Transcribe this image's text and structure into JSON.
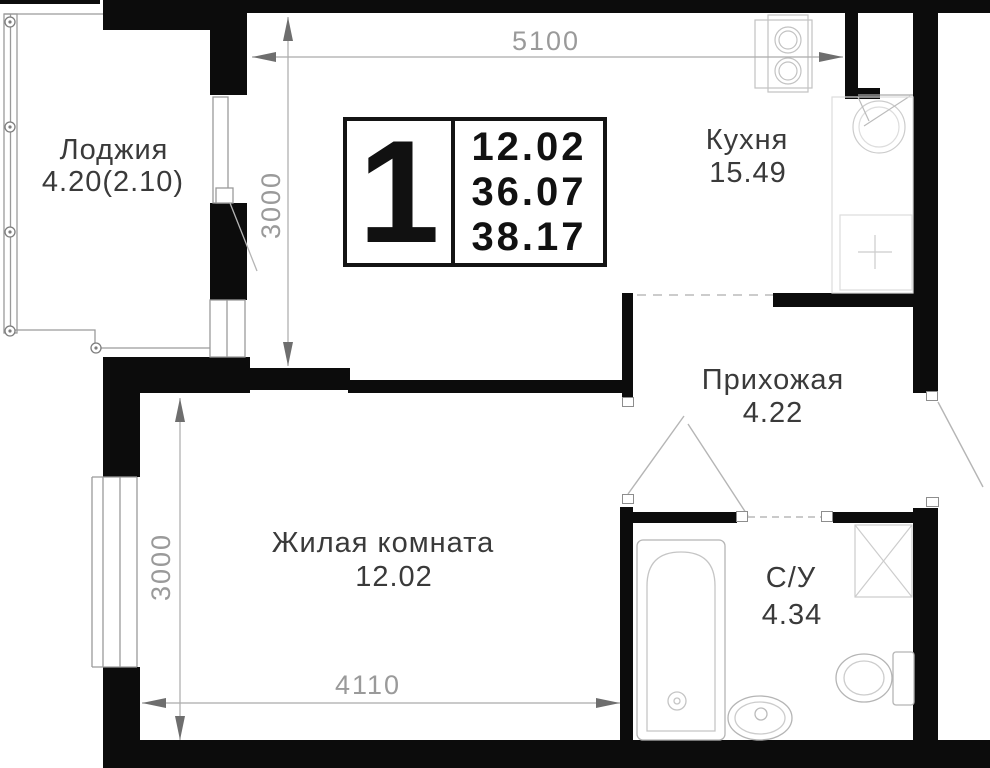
{
  "plan": {
    "badge": {
      "room_count": "1",
      "area_lines": [
        "12.02",
        "36.07",
        "38.17"
      ]
    },
    "rooms": {
      "loggia": {
        "name": "Лоджия",
        "area": "4.20(2.10)"
      },
      "kitchen": {
        "name": "Кухня",
        "area": "15.49"
      },
      "hallway": {
        "name": "Прихожая",
        "area": "4.22"
      },
      "living": {
        "name": "Жилая комната",
        "area": "12.02"
      },
      "bathroom": {
        "name": "С/У",
        "area": "4.34"
      }
    },
    "dimensions": {
      "top": "5100",
      "upper_left": "3000",
      "lower_left": "3000",
      "bottom": "4110"
    },
    "colors": {
      "wall": "#0c0c0c",
      "dimension_text": "#9a9a9a",
      "label_text": "#3a3a3a"
    }
  }
}
